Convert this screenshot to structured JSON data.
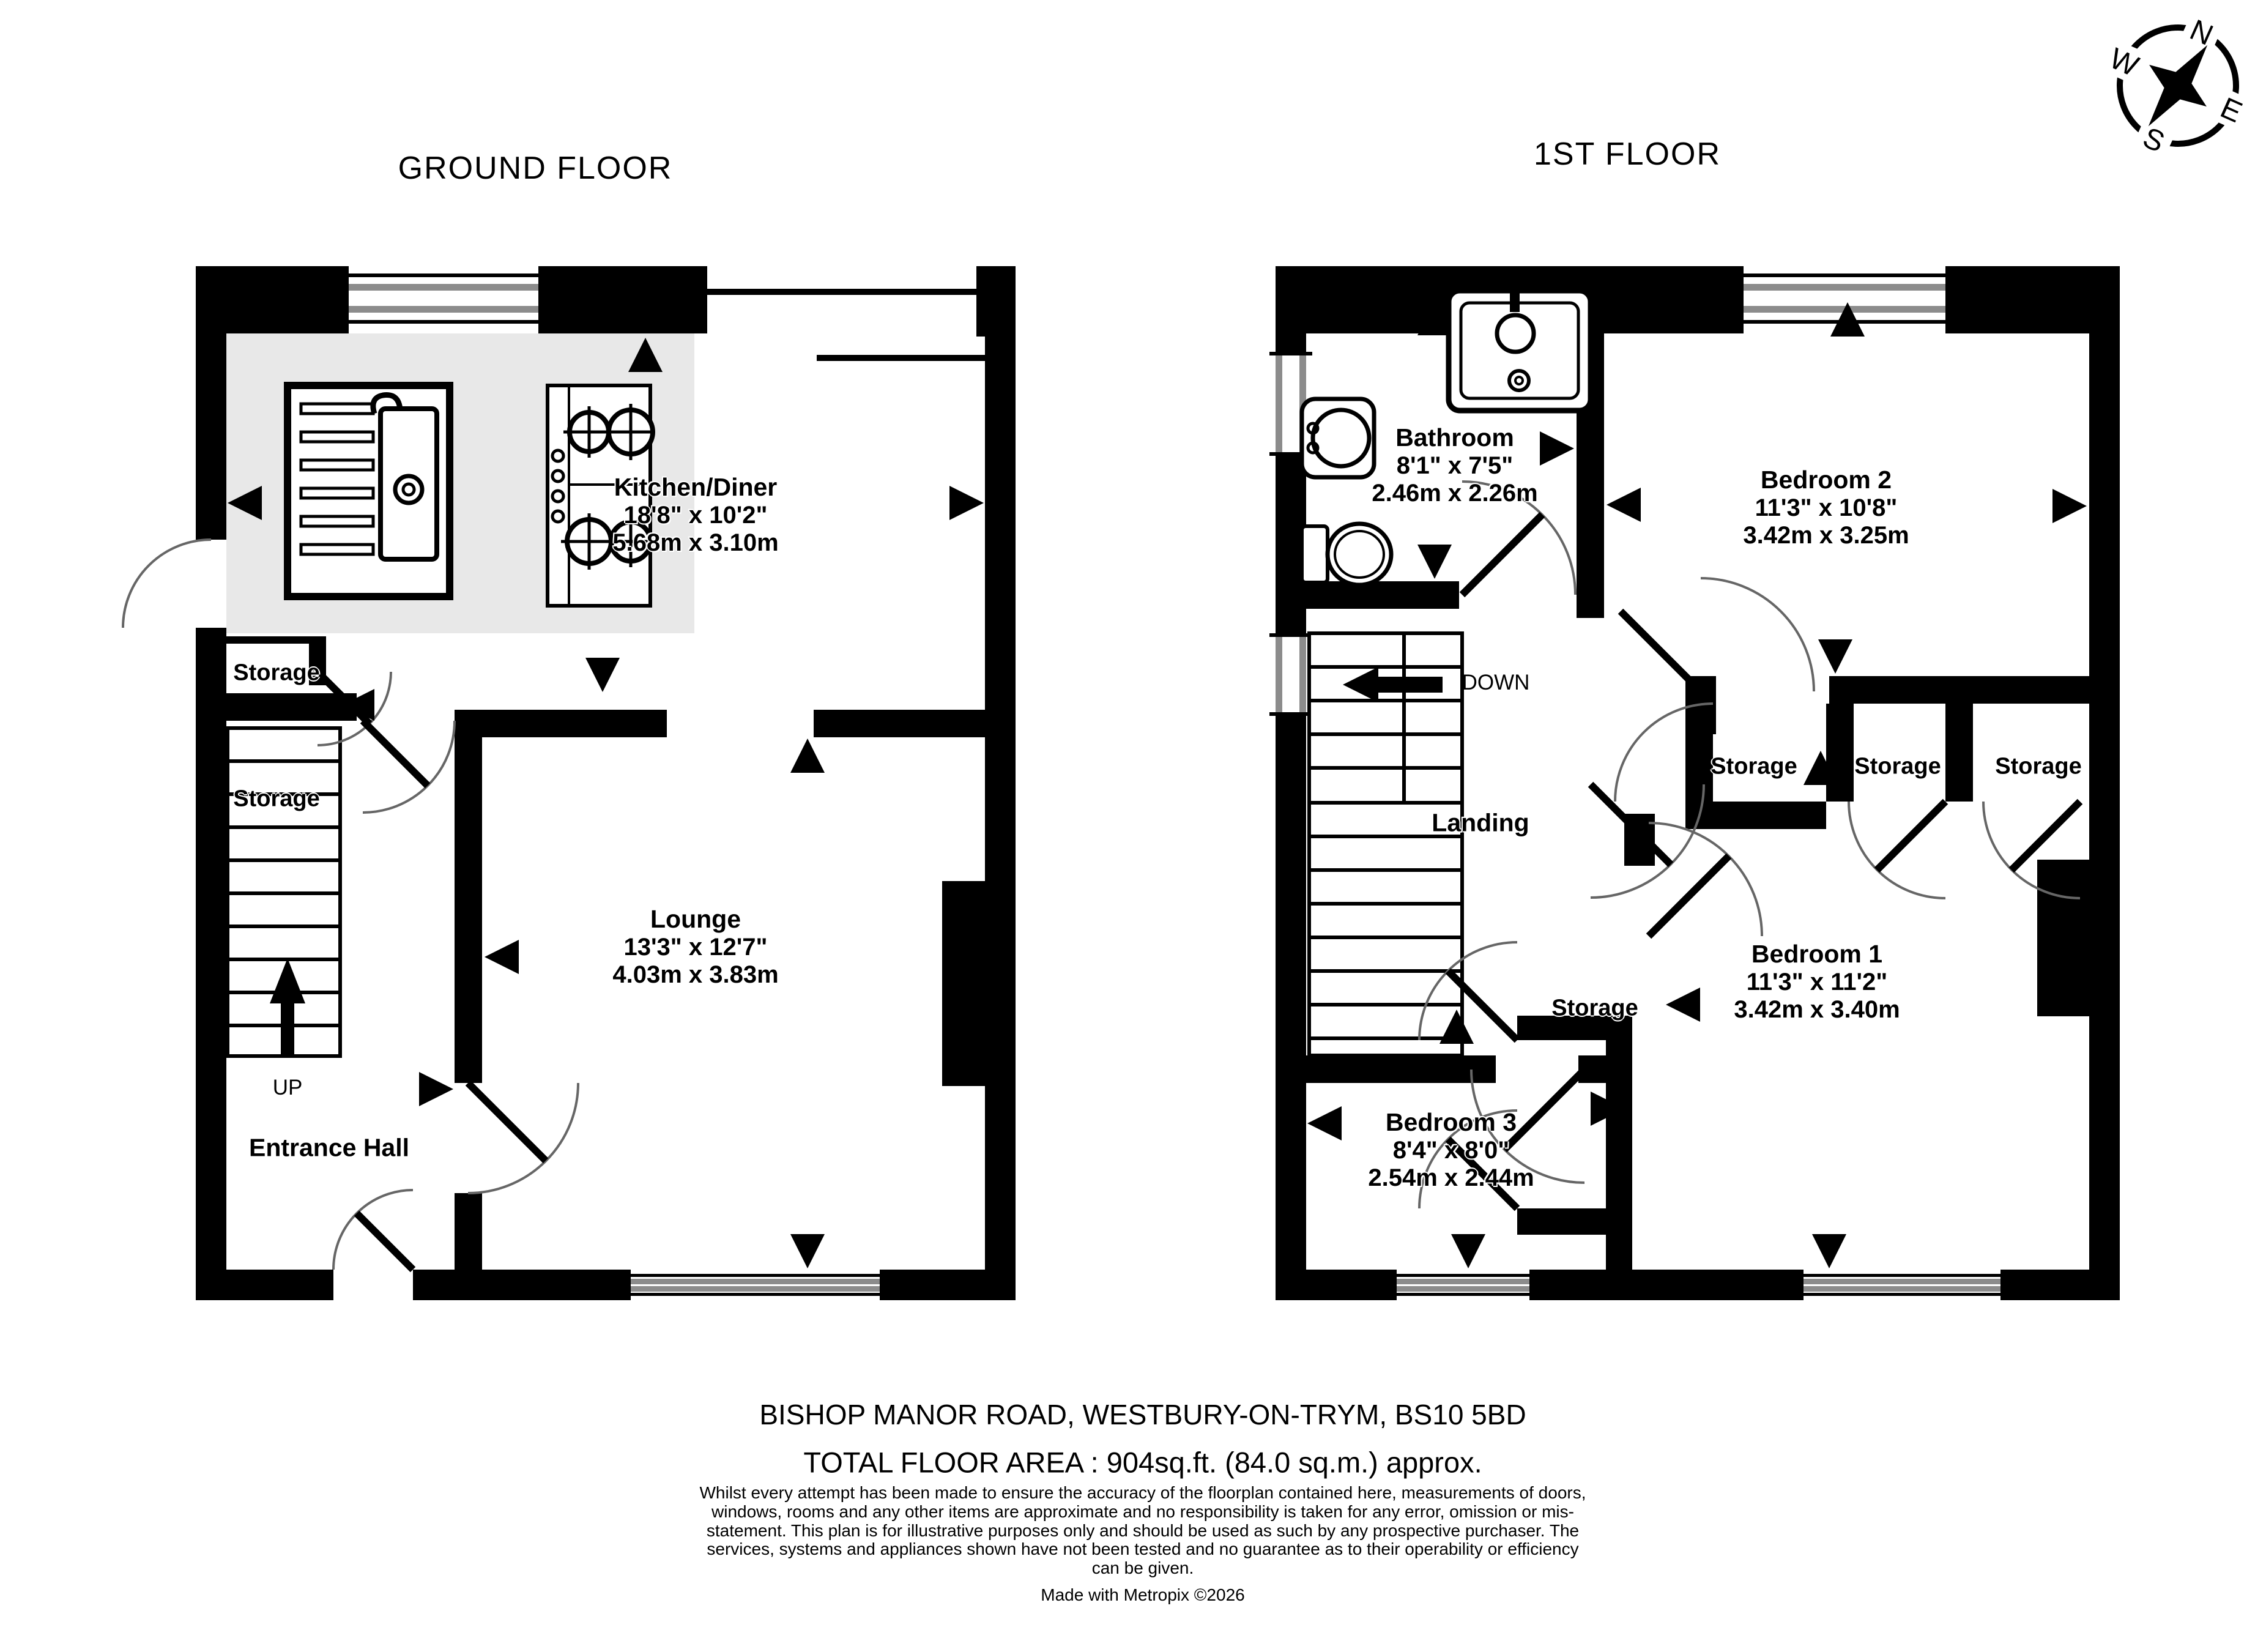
{
  "compass": {
    "n": "N",
    "e": "E",
    "s": "S",
    "w": "W"
  },
  "ground_floor": {
    "title": "GROUND FLOOR",
    "kitchen_diner": {
      "name": "Kitchen/Diner",
      "imperial": "18'8\" x 10'2\"",
      "metric": "5.68m x 3.10m"
    },
    "lounge": {
      "name": "Lounge",
      "imperial": "13'3\" x 12'7\"",
      "metric": "4.03m x 3.83m"
    },
    "entrance_hall": {
      "name": "Entrance Hall"
    },
    "storage_upper": {
      "name": "Storage"
    },
    "storage_understairs": {
      "name": "Storage"
    },
    "stairs_direction": "UP"
  },
  "first_floor": {
    "title": "1ST FLOOR",
    "bathroom": {
      "name": "Bathroom",
      "imperial": "8'1\" x 7'5\"",
      "metric": "2.46m x 2.26m"
    },
    "bedroom2": {
      "name": "Bedroom 2",
      "imperial": "11'3\" x 10'8\"",
      "metric": "3.42m x 3.25m"
    },
    "bedroom1": {
      "name": "Bedroom 1",
      "imperial": "11'3\" x 11'2\"",
      "metric": "3.42m x 3.40m"
    },
    "bedroom3": {
      "name": "Bedroom 3",
      "imperial": "8'4\" x 8'0\"",
      "metric": "2.54m x 2.44m"
    },
    "landing": {
      "name": "Landing"
    },
    "storage_cupboard1": {
      "name": "Storage"
    },
    "storage_cupboard2": {
      "name": "Storage"
    },
    "storage_cupboard3": {
      "name": "Storage"
    },
    "storage_small": {
      "name": "Storage"
    },
    "stairs_direction": "DOWN"
  },
  "footer": {
    "address": "BISHOP MANOR ROAD, WESTBURY-ON-TRYM, BS10 5BD",
    "total_area": "TOTAL FLOOR AREA : 904sq.ft. (84.0 sq.m.) approx.",
    "disclaimer": "Whilst every attempt has been made to ensure the accuracy of the floorplan contained here, measurements of doors, windows, rooms and any other items are approximate and no responsibility is taken for any error, omission or mis-statement. This plan is for illustrative purposes only and should be used as such by any prospective purchaser. The services, systems and appliances shown have not been tested and no guarantee as to their operability or efficiency can be given.",
    "credit": "Made with Metropix ©2026"
  }
}
